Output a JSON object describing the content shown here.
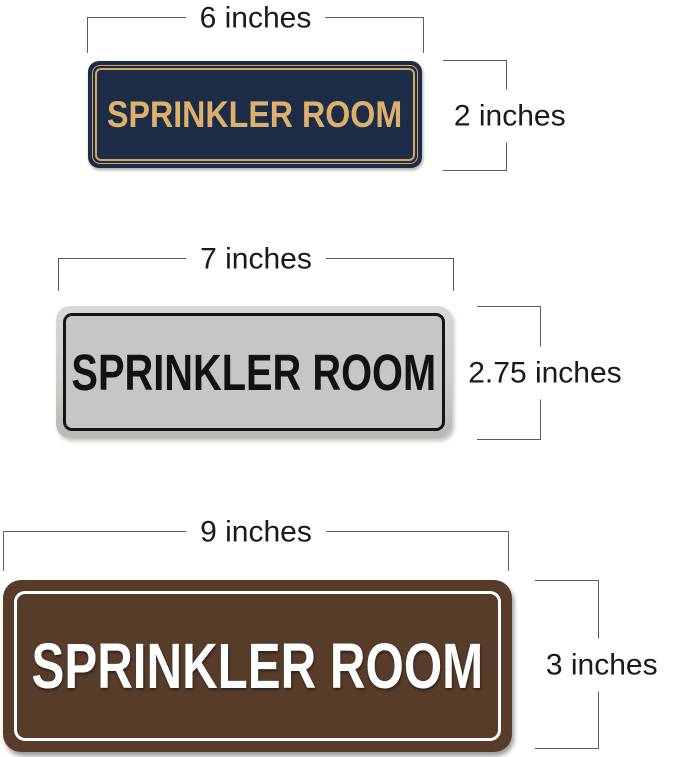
{
  "signs": [
    {
      "id": "navy-gold-6x2",
      "label": "SPRINKLER ROOM",
      "width_label": "6 inches",
      "height_label": "2 inches",
      "colors": {
        "background": "#1d2c47",
        "border": "#d2a763",
        "text": "#ddb06c"
      }
    },
    {
      "id": "silver-black-7x275",
      "label": "SPRINKLER ROOM",
      "width_label": "7 inches",
      "height_label": "2.75 inches",
      "colors": {
        "background": "#c7c6c4",
        "rim": "#d9d8d6",
        "border": "#141414",
        "text": "#121212"
      }
    },
    {
      "id": "walnut-white-9x3",
      "label": "SPRINKLER ROOM",
      "width_label": "9 inches",
      "height_label": "3 inches",
      "colors": {
        "background": "#573c2a",
        "border": "#ffffff",
        "text": "#ffffff"
      }
    }
  ],
  "dimensions": {
    "line_color": "#5c5c5c",
    "text_color": "#1a1a1a"
  }
}
